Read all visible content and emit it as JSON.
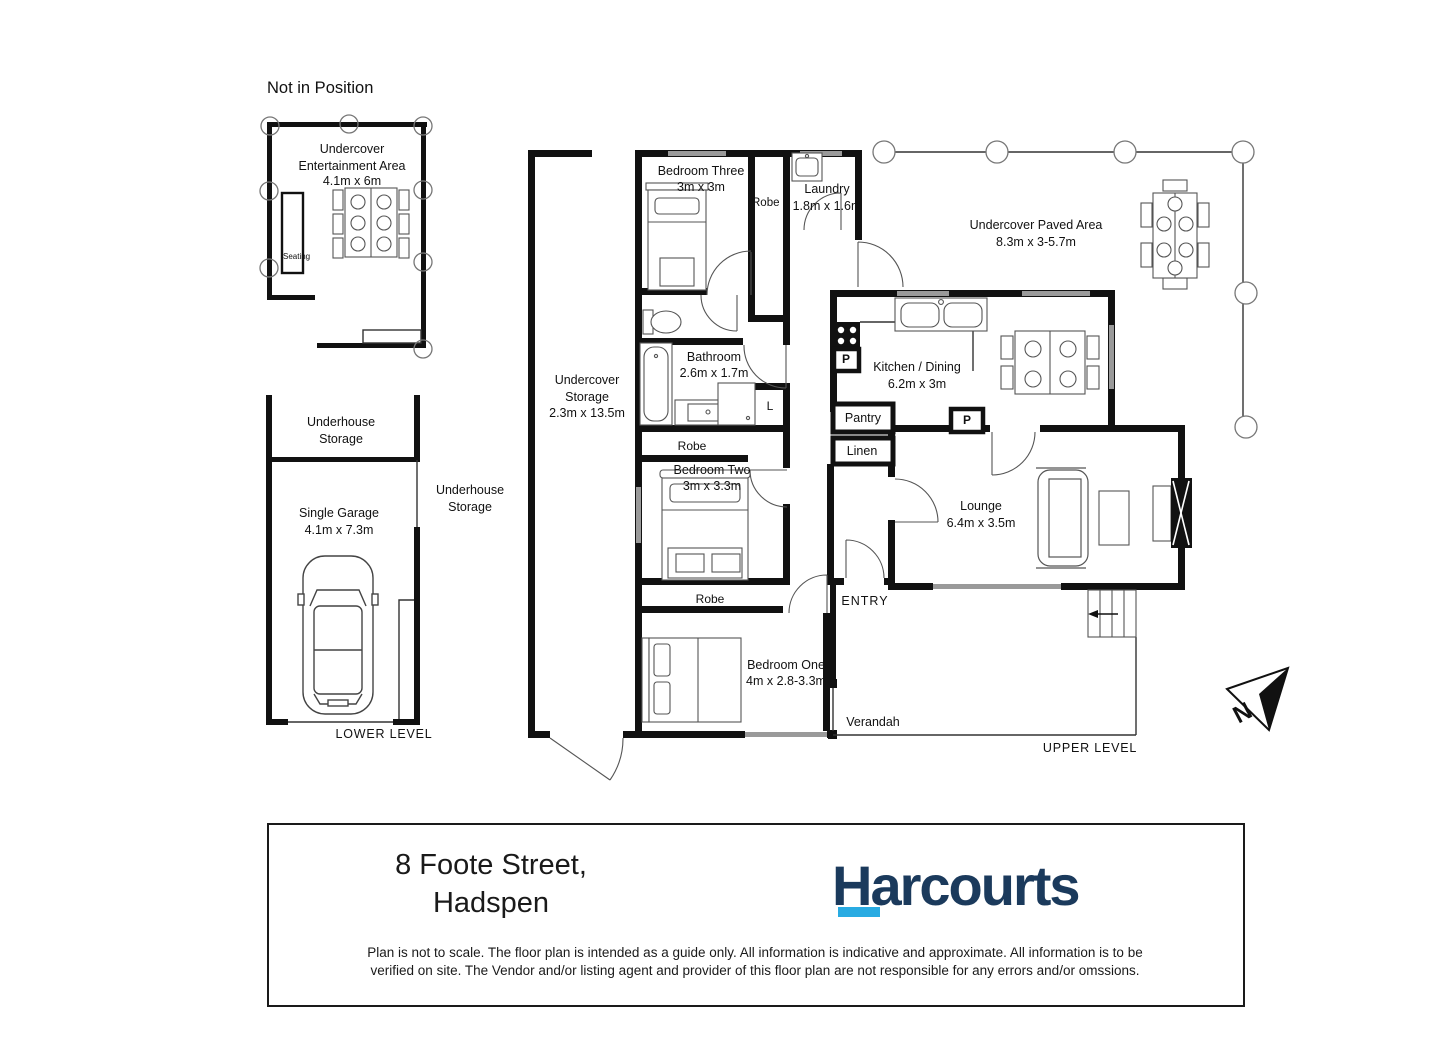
{
  "colors": {
    "wall": "#111111",
    "window": "#9a9a9a",
    "logo_navy": "#1b3a5c",
    "logo_cyan": "#29abe2"
  },
  "titles": {
    "not_in_position": "Not in Position",
    "lower_level": "LOWER LEVEL",
    "upper_level": "UPPER LEVEL"
  },
  "entertainment": {
    "name": "Undercover Entertainment Area",
    "dims": "4.1m x 6m",
    "seating": "Seating"
  },
  "lower_level": {
    "storage_top": "Underhouse Storage",
    "storage_side": "Underhouse Storage",
    "garage": "Single Garage",
    "garage_dims": "4.1m x 7.3m"
  },
  "upper_level": {
    "undercover_storage": "Undercover Storage",
    "undercover_storage_dims": "2.3m x 13.5m",
    "bedroom_three": "Bedroom Three",
    "bedroom_three_dims": "3m x 3m",
    "robe_bed3": "Robe",
    "robe_bed2": "Robe",
    "robe_bed1": "Robe",
    "laundry": "Laundry",
    "laundry_dims": "1.8m x 1.6m",
    "bathroom": "Bathroom",
    "bathroom_dims": "2.6m x 1.7m",
    "linen_cupboard": "L",
    "bedroom_two": "Bedroom Two",
    "bedroom_two_dims": "3m x 3.3m",
    "bedroom_one": "Bedroom One",
    "bedroom_one_dims": "4m x 2.8-3.3m",
    "paved_area": "Undercover Paved Area",
    "paved_area_dims": "8.3m x 3-5.7m",
    "kitchen_dining": "Kitchen / Dining",
    "kitchen_dining_dims": "6.2m x 3m",
    "pantry": "Pantry",
    "pantry_abbr1": "P",
    "pantry_abbr2": "P",
    "linen": "Linen",
    "lounge": "Lounge",
    "lounge_dims": "6.4m x 3.5m",
    "entry": "ENTRY",
    "verandah": "Verandah"
  },
  "compass": {
    "north": "N"
  },
  "footer": {
    "address_line1": "8 Foote Street,",
    "address_line2": "Hadspen",
    "brand": "Harcourts",
    "disclaimer_line1": "Plan is not to scale. The floor plan is intended as a guide only. All information is indicative and approximate. All information is to be",
    "disclaimer_line2": "verified on site. The Vendor and/or listing agent and provider of this floor plan are not responsible for any errors and/or omssions."
  }
}
